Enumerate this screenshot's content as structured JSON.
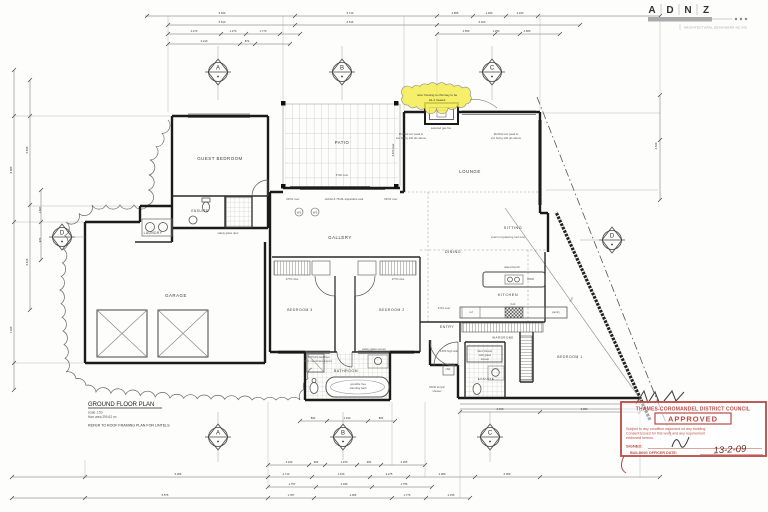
{
  "logo": {
    "l1": "A",
    "l2": "D",
    "l3": "N",
    "l4": "Z",
    "subtitle": "ARCHITECTURAL DESIGNERS NZ INC"
  },
  "title_block": {
    "title": "GROUND FLOOR PLAN",
    "scale": "scale 1:50",
    "area": "floor area 290.62 m²",
    "note": "REFER TO ROOF FRAMING PLAN FOR LINTELS"
  },
  "note_cloud": {
    "line1": "note: framing to chimney to be",
    "line2": "H1.2 treated"
  },
  "rooms": {
    "guest_bedroom": "GUEST BEDROOM",
    "ensuite_guest": "ENSUITE",
    "laundry": "LAUNDRY",
    "garage": "GARAGE",
    "patio": "PATIO",
    "gallery": "GALLERY",
    "lounge": "LOUNGE",
    "sitting": "SITTING",
    "dining": "DINING",
    "kitchen": "KITCHEN",
    "entry": "ENTRY",
    "wardrobe": "WARDROBE",
    "bedroom1": "BEDROOM 1",
    "bedroom2": "BEDROOM 2",
    "bedroom3": "BEDROOM 3",
    "bathroom": "BATHROOM",
    "ensuite_main": "ENSUITE"
  },
  "grid_markers": {
    "a": "A",
    "b": "B",
    "c": "C",
    "d": "D"
  },
  "stamp": {
    "council": "THAMES-COROMANDEL DISTRICT COUNCIL",
    "approved": "APPROVED",
    "body1": "Subject to any condition endorsed on any building",
    "body2": "Consent issued for this work and any requirement",
    "body3": "endorsed hereon.",
    "signed_label": "SIGNED:",
    "officer_label": "BUILDING OFFICER DATE:",
    "date": "13-2-09"
  },
  "colors": {
    "stamp_red": "#b94a45",
    "highlight_yellow": "#f3ec4f",
    "line_dark": "#1b1b1b"
  },
  "window_tags": [
    "W2",
    "W3"
  ],
  "dim_texts": [
    {
      "t": "5.940",
      "x": 222,
      "y": 14
    },
    {
      "t": "6.710",
      "x": 350,
      "y": 14
    },
    {
      "t": "2.855",
      "x": 455,
      "y": 14
    },
    {
      "t": "1.250",
      "x": 489,
      "y": 14
    },
    {
      "t": "2.400",
      "x": 520,
      "y": 14
    },
    {
      "t": "5.510",
      "x": 222,
      "y": 23
    },
    {
      "t": "6.516",
      "x": 350,
      "y": 23
    },
    {
      "t": "6.320",
      "x": 482,
      "y": 23
    },
    {
      "t": "2.470",
      "x": 194,
      "y": 32
    },
    {
      "t": "1.270",
      "x": 233,
      "y": 32
    },
    {
      "t": "1.770",
      "x": 263,
      "y": 32
    },
    {
      "t": "2.550",
      "x": 466,
      "y": 32
    },
    {
      "t": "1.250",
      "x": 496,
      "y": 32
    },
    {
      "t": "2.580",
      "x": 527,
      "y": 32
    },
    {
      "t": "3.210",
      "x": 204,
      "y": 42
    },
    {
      "t": "870",
      "x": 247,
      "y": 42
    },
    {
      "t": "3.230",
      "x": 289,
      "y": 463
    },
    {
      "t": "960",
      "x": 316,
      "y": 463
    },
    {
      "t": "1.970",
      "x": 344,
      "y": 463
    },
    {
      "t": "960",
      "x": 369,
      "y": 463
    },
    {
      "t": "2.205",
      "x": 404,
      "y": 463
    },
    {
      "t": "6.066",
      "x": 178,
      "y": 475
    },
    {
      "t": "2.710",
      "x": 286,
      "y": 475
    },
    {
      "t": "1.919",
      "x": 341,
      "y": 475
    },
    {
      "t": "3.275",
      "x": 389,
      "y": 475
    },
    {
      "t": "2.980",
      "x": 442,
      "y": 475
    },
    {
      "t": "6.059",
      "x": 507,
      "y": 475
    },
    {
      "t": "1.757",
      "x": 292,
      "y": 485
    },
    {
      "t": "4.039",
      "x": 344,
      "y": 485
    },
    {
      "t": "1.756",
      "x": 404,
      "y": 485
    },
    {
      "t": "5.575",
      "x": 165,
      "y": 496
    },
    {
      "t": "1.787",
      "x": 291,
      "y": 496
    },
    {
      "t": "4.006",
      "x": 353,
      "y": 496
    },
    {
      "t": "1.776",
      "x": 407,
      "y": 496
    },
    {
      "t": "2.156",
      "x": 451,
      "y": 496
    },
    {
      "t": "2.400",
      "x": 500,
      "y": 410
    },
    {
      "t": "3.090",
      "x": 584,
      "y": 410
    },
    {
      "t": "860",
      "x": 313,
      "y": 419
    },
    {
      "t": "1.910",
      "x": 347,
      "y": 419
    },
    {
      "t": "860",
      "x": 381,
      "y": 419
    },
    {
      "t": "8.685",
      "x": 12,
      "y": 170,
      "r": -90
    },
    {
      "t": "7.165",
      "x": 12,
      "y": 330,
      "r": -90
    },
    {
      "t": "5.845",
      "x": 28,
      "y": 150,
      "r": -90
    },
    {
      "t": "6.425",
      "x": 28,
      "y": 262,
      "r": -90
    },
    {
      "t": "1.607",
      "x": 41,
      "y": 210,
      "r": -90
    },
    {
      "t": "970",
      "x": 41,
      "y": 240,
      "r": -90
    },
    {
      "t": "4.540",
      "x": 657,
      "y": 146,
      "r": -90
    },
    {
      "t": "4.873 over",
      "x": 394,
      "y": 150,
      "r": -90
    }
  ],
  "dim_lines": [
    {
      "o": "h",
      "y": 16,
      "a": 145,
      "b": 660,
      "t": [
        147,
        295,
        437,
        473,
        506,
        538,
        660
      ]
    },
    {
      "o": "h",
      "y": 25,
      "a": 168,
      "b": 580,
      "t": [
        168,
        295,
        437,
        580
      ]
    },
    {
      "o": "h",
      "y": 34,
      "a": 168,
      "b": 300,
      "t": [
        168,
        221,
        246,
        280,
        300
      ]
    },
    {
      "o": "h",
      "y": 34,
      "a": 437,
      "b": 560,
      "t": [
        437,
        495,
        520,
        560
      ]
    },
    {
      "o": "h",
      "y": 44,
      "a": 168,
      "b": 290,
      "t": [
        168,
        240,
        255,
        290
      ]
    },
    {
      "o": "h",
      "y": 465,
      "a": 268,
      "b": 425,
      "t": [
        268,
        309,
        325,
        357,
        381,
        425
      ]
    },
    {
      "o": "h",
      "y": 477,
      "a": 12,
      "b": 660,
      "t": [
        12,
        85,
        268,
        312,
        370,
        408,
        475,
        540,
        660
      ]
    },
    {
      "o": "h",
      "y": 487,
      "a": 268,
      "b": 432,
      "t": [
        268,
        316,
        372,
        432
      ]
    },
    {
      "o": "h",
      "y": 498,
      "a": 12,
      "b": 470,
      "t": [
        12,
        85,
        268,
        314,
        392,
        426,
        470
      ]
    },
    {
      "o": "h",
      "y": 412,
      "a": 460,
      "b": 640,
      "t": [
        460,
        540,
        640
      ]
    },
    {
      "o": "h",
      "y": 421,
      "a": 300,
      "b": 395,
      "t": [
        300,
        327,
        368,
        395
      ]
    },
    {
      "o": "v",
      "x": 14,
      "a": 70,
      "b": 390,
      "t": [
        70,
        116,
        222,
        363,
        390
      ]
    },
    {
      "o": "v",
      "x": 30,
      "a": 80,
      "b": 310,
      "t": [
        80,
        116,
        205,
        310
      ]
    },
    {
      "o": "v",
      "x": 41,
      "a": 190,
      "b": 260,
      "t": [
        190,
        222,
        260
      ]
    },
    {
      "o": "v",
      "x": 660,
      "a": 95,
      "b": 200,
      "t": [
        95,
        140,
        200
      ]
    },
    {
      "o": "v",
      "x": 168,
      "a": 16,
      "b": 112,
      "w": 0.35,
      "c": "#999"
    },
    {
      "o": "v",
      "x": 283,
      "a": 16,
      "b": 101,
      "w": 0.35,
      "c": "#999"
    },
    {
      "o": "v",
      "x": 404,
      "a": 16,
      "b": 110,
      "w": 0.35,
      "c": "#999"
    },
    {
      "o": "v",
      "x": 540,
      "a": 16,
      "b": 110,
      "w": 0.35,
      "c": "#999"
    },
    {
      "o": "v",
      "x": 437,
      "a": 34,
      "b": 106,
      "w": 0.35,
      "c": "#999"
    },
    {
      "o": "v",
      "x": 660,
      "a": 16,
      "b": 93,
      "w": 0.35,
      "c": "#999"
    },
    {
      "o": "v",
      "x": 85,
      "a": 460,
      "b": 477,
      "w": 0.35,
      "c": "#999"
    },
    {
      "o": "v",
      "x": 268,
      "a": 402,
      "b": 487,
      "w": 0.35,
      "c": "#999"
    },
    {
      "o": "v",
      "x": 392,
      "a": 402,
      "b": 465,
      "w": 0.35,
      "c": "#999"
    },
    {
      "o": "v",
      "x": 425,
      "a": 402,
      "b": 477,
      "w": 0.35,
      "c": "#999"
    },
    {
      "o": "v",
      "x": 460,
      "a": 410,
      "b": 498,
      "w": 0.35,
      "c": "#999"
    },
    {
      "o": "v",
      "x": 640,
      "a": 400,
      "b": 477,
      "w": 0.35,
      "c": "#999"
    },
    {
      "o": "h",
      "y": 116,
      "a": 14,
      "b": 170,
      "w": 0.35,
      "c": "#999"
    },
    {
      "o": "h",
      "y": 222,
      "a": 14,
      "b": 83,
      "w": 0.35,
      "c": "#999"
    },
    {
      "o": "h",
      "y": 363,
      "a": 14,
      "b": 83,
      "w": 0.35,
      "c": "#999"
    },
    {
      "o": "h",
      "y": 206,
      "a": 30,
      "b": 138,
      "w": 0.35,
      "c": "#999"
    },
    {
      "o": "h",
      "y": 113,
      "a": 542,
      "b": 660,
      "w": 0.35,
      "c": "#999"
    },
    {
      "o": "h",
      "y": 190,
      "a": 546,
      "b": 658,
      "w": 0.35,
      "c": "#999"
    },
    {
      "o": "v",
      "x": 218,
      "a": 46,
      "b": 61,
      "w": 0.4,
      "c": "#888"
    },
    {
      "o": "v",
      "x": 218,
      "a": 83,
      "b": 100,
      "w": 0.4,
      "c": "#888"
    },
    {
      "o": "v",
      "x": 342,
      "a": 46,
      "b": 61,
      "w": 0.4,
      "c": "#888"
    },
    {
      "o": "v",
      "x": 342,
      "a": 83,
      "b": 100,
      "w": 0.4,
      "c": "#888"
    },
    {
      "o": "v",
      "x": 492,
      "a": 46,
      "b": 61,
      "w": 0.4,
      "c": "#888"
    },
    {
      "o": "v",
      "x": 492,
      "a": 83,
      "b": 100,
      "w": 0.4,
      "c": "#888"
    },
    {
      "o": "v",
      "x": 218,
      "a": 412,
      "b": 426,
      "w": 0.4,
      "c": "#888"
    },
    {
      "o": "v",
      "x": 218,
      "a": 448,
      "b": 462,
      "w": 0.4,
      "c": "#888"
    },
    {
      "o": "v",
      "x": 343,
      "a": 412,
      "b": 426,
      "w": 0.4,
      "c": "#888"
    },
    {
      "o": "v",
      "x": 343,
      "a": 448,
      "b": 460,
      "w": 0.4,
      "c": "#888"
    },
    {
      "o": "v",
      "x": 490,
      "a": 412,
      "b": 426,
      "w": 0.4,
      "c": "#888"
    },
    {
      "o": "v",
      "x": 490,
      "a": 448,
      "b": 462,
      "w": 0.4,
      "c": "#888"
    },
    {
      "o": "h",
      "y": 237,
      "a": 73,
      "b": 85,
      "w": 0.4,
      "c": "#888"
    },
    {
      "o": "h",
      "y": 240,
      "a": 580,
      "b": 601,
      "w": 0.4,
      "c": "#888"
    }
  ],
  "note_texts": [
    {
      "t": "RF01 over",
      "x": 293,
      "y": 200
    },
    {
      "t": "Hobbs & 7616L adjustable seal",
      "x": 344,
      "y": 200
    },
    {
      "t": "RF01 over",
      "x": 391,
      "y": 200
    },
    {
      "t": "6702 over",
      "x": 342,
      "y": 176
    },
    {
      "t": "selected gas fire",
      "x": 441,
      "y": 129
    },
    {
      "t": "Pln/Fkd s/w peak to",
      "x": 411,
      "y": 135
    },
    {
      "t": "s/w being 140 pfc above",
      "x": 411,
      "y": 139
    },
    {
      "t": "Pln/Fkd s/w peak to",
      "x": 506,
      "y": 135
    },
    {
      "t": "s/w being 140 pfc above",
      "x": 506,
      "y": 139
    },
    {
      "t": "extent of guttering roof over",
      "x": 508,
      "y": 238
    },
    {
      "t": "roof",
      "x": 572,
      "y": 300,
      "r": -55
    },
    {
      "t": "island bench",
      "x": 512,
      "y": 268
    },
    {
      "t": "hob",
      "x": 513,
      "y": 305
    },
    {
      "t": "ref",
      "x": 471,
      "y": 313
    },
    {
      "t": "pantry",
      "x": 556,
      "y": 313
    },
    {
      "t": "9713 over",
      "x": 444,
      "y": 309
    },
    {
      "t": "1400 high wall",
      "x": 449,
      "y": 352
    },
    {
      "t": "tiled shower",
      "x": 485,
      "y": 352
    },
    {
      "t": "with glass",
      "x": 485,
      "y": 356
    },
    {
      "t": "screen",
      "x": 485,
      "y": 360
    },
    {
      "t": "safety glass door",
      "x": 228,
      "y": 234
    },
    {
      "t": "safety glass screen",
      "x": 374,
      "y": 350
    },
    {
      "t": "TIL/TG01 tiled floor",
      "x": 318,
      "y": 358
    },
    {
      "t": "floor membrane (wpm)",
      "x": 318,
      "y": 362
    },
    {
      "t": "possible free",
      "x": 358,
      "y": 385
    },
    {
      "t": "standing bath",
      "x": 358,
      "y": 389
    },
    {
      "t": "2770 robe",
      "x": 292,
      "y": 280
    },
    {
      "t": "2770 robe",
      "x": 398,
      "y": 280
    },
    {
      "t": "HW",
      "x": 448,
      "y": 370
    },
    {
      "t": "60/40 acrylic",
      "x": 437,
      "y": 388
    },
    {
      "t": "shower",
      "x": 437,
      "y": 392
    }
  ]
}
